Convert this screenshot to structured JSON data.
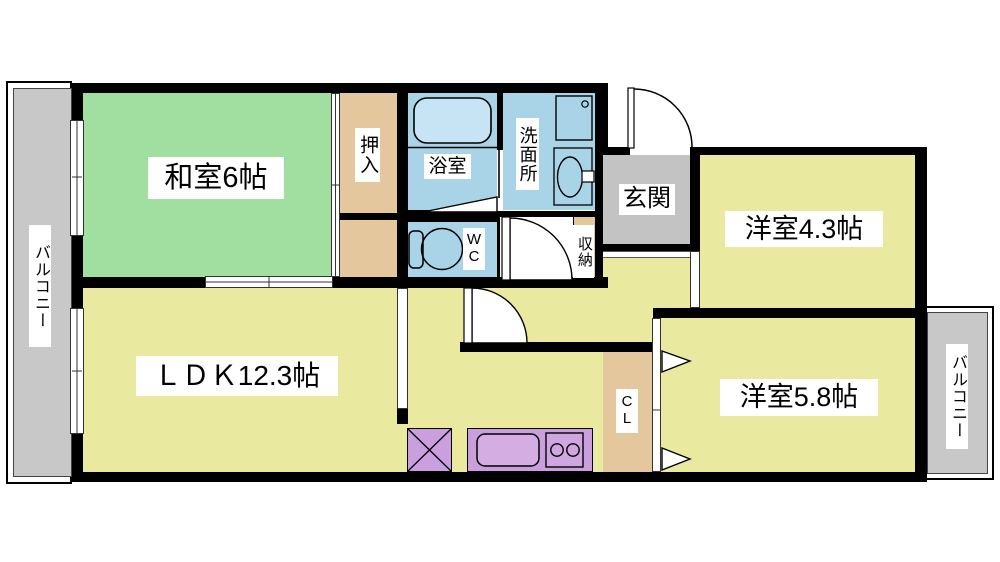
{
  "floorplan": {
    "rooms": {
      "washitsu": {
        "label": "和室6帖",
        "color": "#a0dfa0"
      },
      "ldk": {
        "label": "ＬＤＫ12.3帖",
        "color": "#e9e9a0"
      },
      "western_4_3": {
        "label": "洋室4.3帖",
        "color": "#e9e9a0"
      },
      "western_5_8": {
        "label": "洋室5.8帖",
        "color": "#e9e9a0"
      },
      "genkan": {
        "label": "玄関",
        "color": "#c3c3c3"
      },
      "bath": {
        "label": "浴室",
        "color": "#a9d4e8"
      },
      "washroom": {
        "label": "洗面所",
        "color": "#a9d4e8"
      },
      "wc": {
        "label": "W\nC",
        "color": "#a9d4e8"
      },
      "oshiire": {
        "label": "押入",
        "color": "#e4c79c"
      },
      "storage": {
        "label": "収納",
        "color": "#e4c79c"
      },
      "closet_cl": {
        "label": "C\nL",
        "color": "#e4c79c"
      },
      "balcony_left": {
        "label": "バルコニー",
        "color": "#c8c8c8"
      },
      "balcony_right": {
        "label": "バルコニー",
        "color": "#c8c8c8"
      }
    },
    "wall_color": "#000000",
    "kitchen_counter_color": "#c9a0dd",
    "label_background": "#ffffff"
  }
}
